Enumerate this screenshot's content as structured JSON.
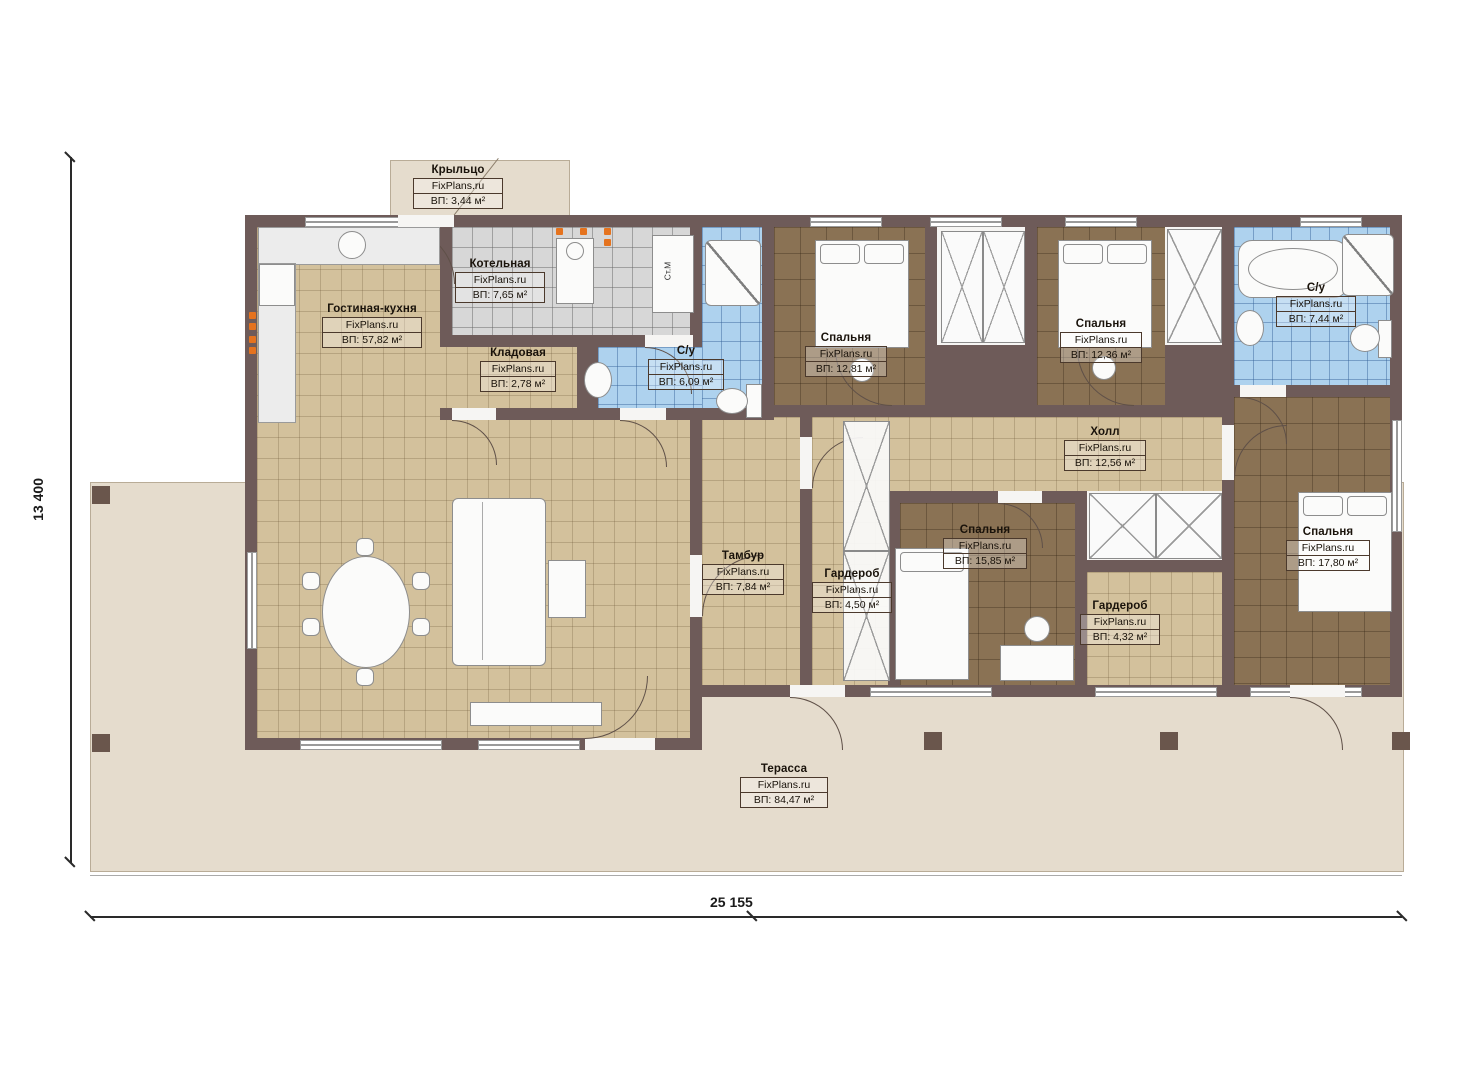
{
  "plan": {
    "brand": "FixPlans.ru",
    "rooms": [
      {
        "id": "porch",
        "name": "Крыльцо",
        "brand": "FixPlans.ru",
        "area": "ВП: 3,44 м²"
      },
      {
        "id": "boiler",
        "name": "Котельная",
        "brand": "FixPlans.ru",
        "area": "ВП: 7,65 м²"
      },
      {
        "id": "living-kitchen",
        "name": "Гостиная-кухня",
        "brand": "FixPlans.ru",
        "area": "ВП: 57,82 м²"
      },
      {
        "id": "pantry",
        "name": "Кладовая",
        "brand": "FixPlans.ru",
        "area": "ВП: 2,78 м²"
      },
      {
        "id": "bath-1",
        "name": "С/у",
        "brand": "FixPlans.ru",
        "area": "ВП: 6,09 м²"
      },
      {
        "id": "bedroom-1",
        "name": "Спальня",
        "brand": "FixPlans.ru",
        "area": "ВП: 12,81 м²"
      },
      {
        "id": "bedroom-2",
        "name": "Спальня",
        "brand": "FixPlans.ru",
        "area": "ВП: 12,36 м²"
      },
      {
        "id": "bath-2",
        "name": "С/у",
        "brand": "FixPlans.ru",
        "area": "ВП: 7,44 м²"
      },
      {
        "id": "hall",
        "name": "Холл",
        "brand": "FixPlans.ru",
        "area": "ВП: 12,56 м²"
      },
      {
        "id": "vestibule",
        "name": "Тамбур",
        "brand": "FixPlans.ru",
        "area": "ВП: 7,84 м²"
      },
      {
        "id": "wardrobe-1",
        "name": "Гардероб",
        "brand": "FixPlans.ru",
        "area": "ВП: 4,50 м²"
      },
      {
        "id": "bedroom-3",
        "name": "Спальня",
        "brand": "FixPlans.ru",
        "area": "ВП: 15,85 м²"
      },
      {
        "id": "wardrobe-2",
        "name": "Гардероб",
        "brand": "FixPlans.ru",
        "area": "ВП: 4,32 м²"
      },
      {
        "id": "bedroom-4",
        "name": "Спальня",
        "brand": "FixPlans.ru",
        "area": "ВП: 17,80 м²"
      },
      {
        "id": "terrace",
        "name": "Терасса",
        "brand": "FixPlans.ru",
        "area": "ВП: 84,47 м²"
      }
    ],
    "dimensions": {
      "bottom": "25 155",
      "left": "13 400"
    },
    "annotations": {
      "washing_machine": "Ст.М"
    },
    "colors": {
      "wall": "#6e5b59",
      "floor_beige": "#d3c19c",
      "floor_brown": "#8a7254",
      "floor_blue": "#aed2ee",
      "floor_gray": "#d7d7d7",
      "terrace": "#e5dccd",
      "light_accent": "#e5731e"
    }
  }
}
